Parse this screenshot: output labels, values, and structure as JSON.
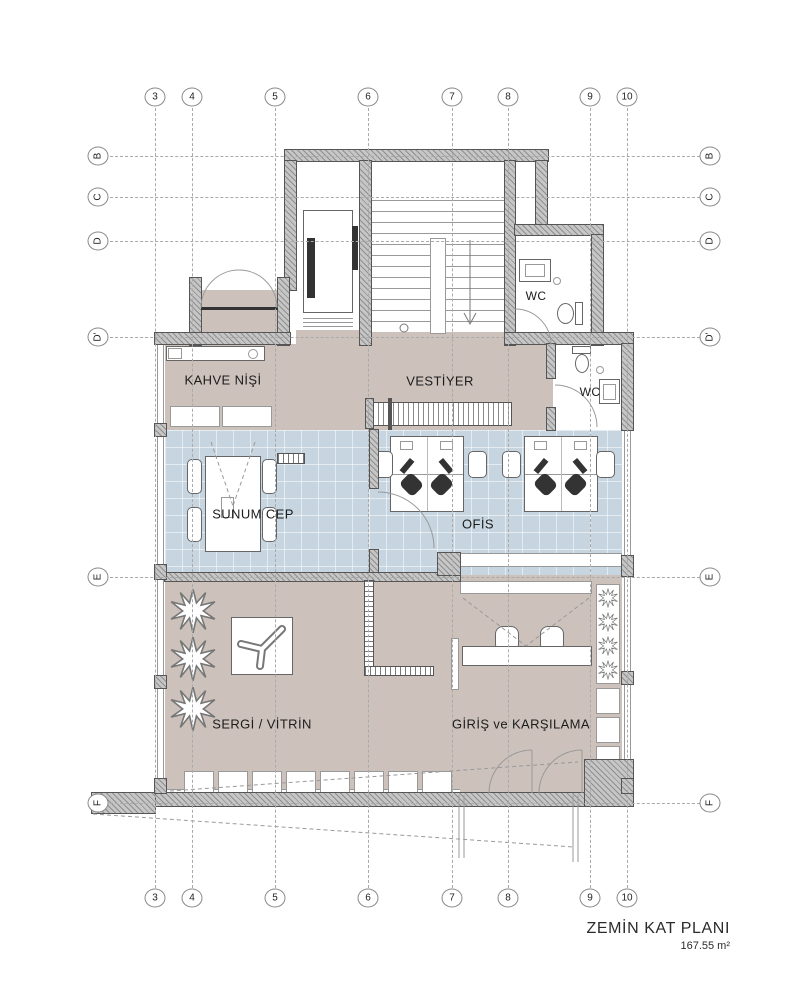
{
  "title_block": {
    "title": "ZEMİN KAT PLANI",
    "area": "167.55 m²"
  },
  "grid": {
    "columns": [
      {
        "label": "3",
        "x": 155
      },
      {
        "label": "4",
        "x": 192
      },
      {
        "label": "5",
        "x": 275
      },
      {
        "label": "6",
        "x": 368
      },
      {
        "label": "7",
        "x": 452
      },
      {
        "label": "8",
        "x": 508
      },
      {
        "label": "9",
        "x": 590
      },
      {
        "label": "10",
        "x": 627
      }
    ],
    "rows": [
      {
        "label": "B",
        "y": 156
      },
      {
        "label": "C",
        "y": 197
      },
      {
        "label": "D",
        "y": 241
      },
      {
        "label": "D'",
        "y": 337
      },
      {
        "label": "E",
        "y": 577
      },
      {
        "label": "F",
        "y": 803
      }
    ]
  },
  "room_labels": [
    {
      "id": "kahve-nisi",
      "text": "KAHVE NİŞİ",
      "x": 223,
      "y": 380,
      "size": 13
    },
    {
      "id": "vestiyer",
      "text": "VESTİYER",
      "x": 440,
      "y": 381,
      "size": 13
    },
    {
      "id": "wc-upper",
      "text": "WC",
      "x": 536,
      "y": 296,
      "size": 12
    },
    {
      "id": "wc-lower",
      "text": "WC",
      "x": 590,
      "y": 392,
      "size": 12
    },
    {
      "id": "sunum-cep",
      "text": "SUNUM CEP",
      "x": 253,
      "y": 514,
      "size": 13
    },
    {
      "id": "ofis",
      "text": "OFİS",
      "x": 478,
      "y": 524,
      "size": 13
    },
    {
      "id": "sergi-vitrin",
      "text": "SERGİ / VİTRİN",
      "x": 262,
      "y": 724,
      "size": 13
    },
    {
      "id": "giris-karsilama",
      "text": "GİRİŞ ve KARŞILAMA",
      "x": 521,
      "y": 724,
      "size": 13
    }
  ],
  "colors": {
    "floor_warm": "#ccc1bb",
    "floor_cool": "#c6d5e0",
    "wall_fill": "#c6c6c6",
    "wall_hatch": "#8f8f8f",
    "grid_line": "#aaaaaa",
    "line": "#666666"
  }
}
